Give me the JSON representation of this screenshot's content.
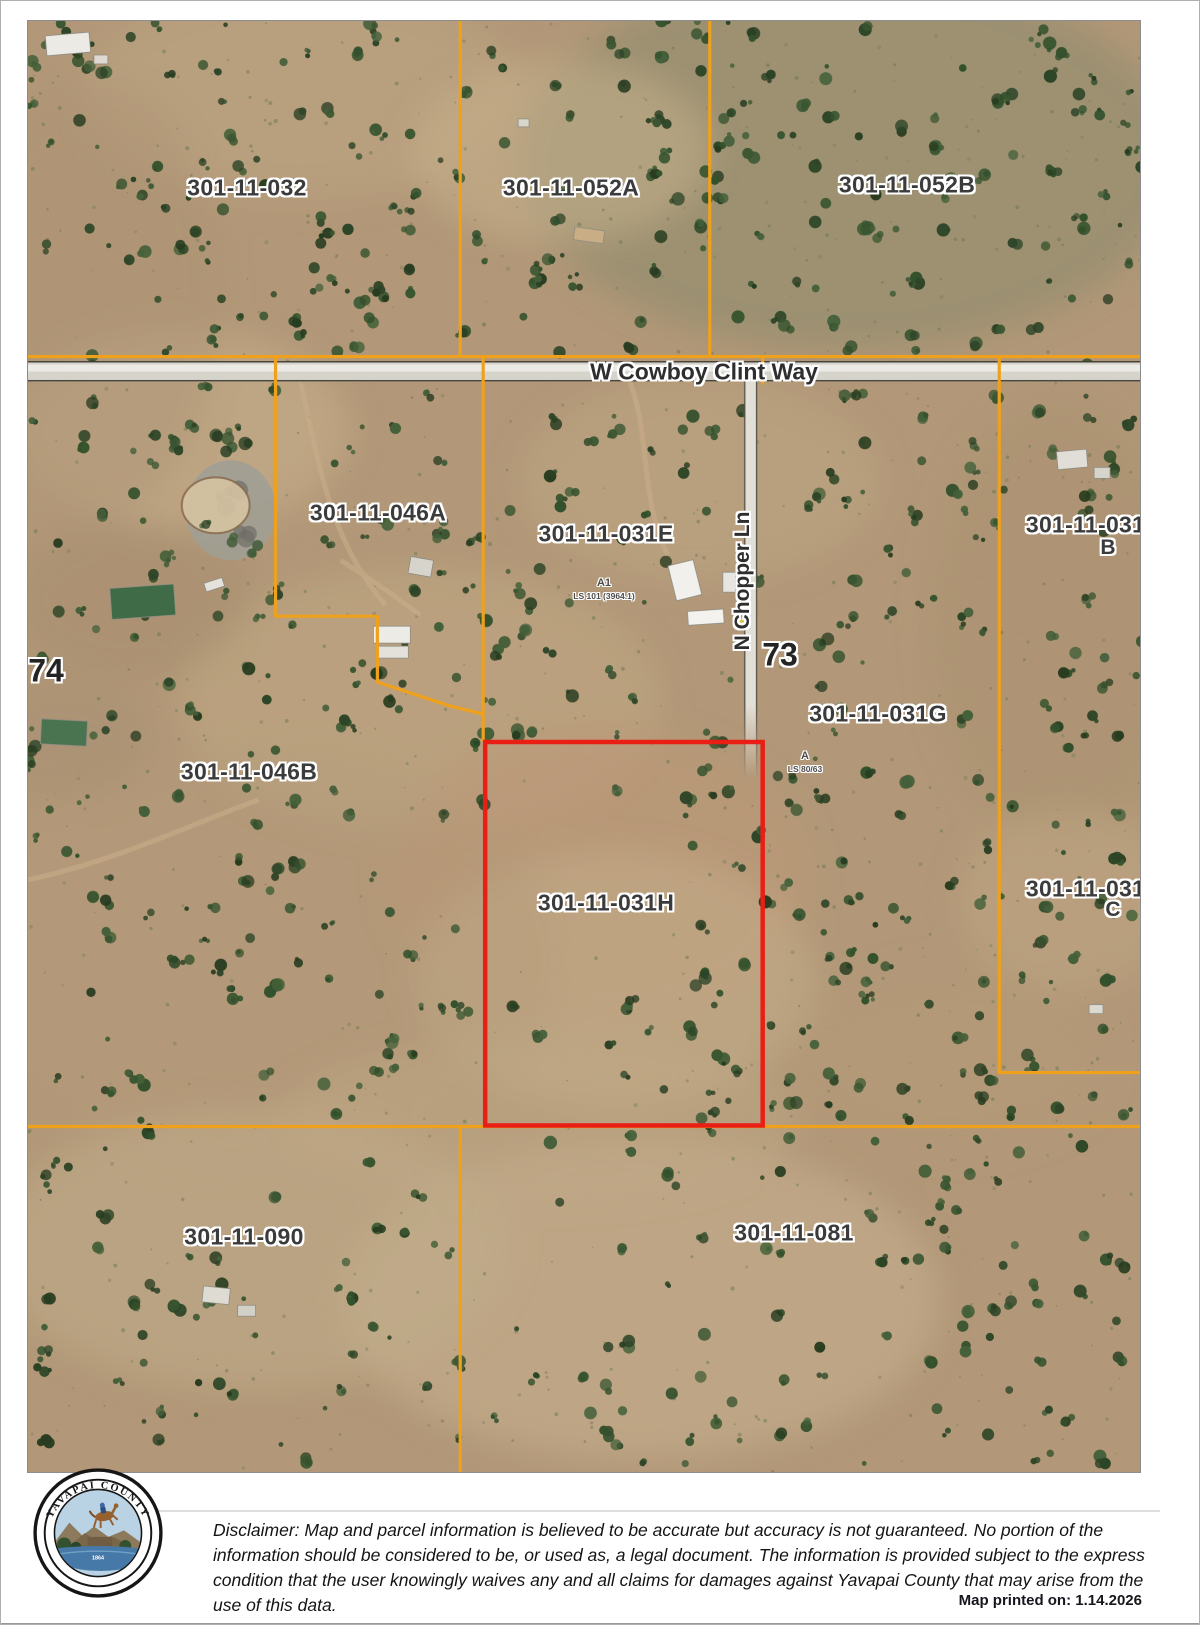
{
  "map": {
    "roads": {
      "horizontal_label": "W Cowboy Clint Way",
      "vertical_label": "N Chopper Ln"
    },
    "parcel_labels": [
      {
        "text": "301-11-032",
        "x": 246,
        "y": 187
      },
      {
        "text": "301-11-052A",
        "x": 570,
        "y": 187
      },
      {
        "text": "301-11-052B",
        "x": 906,
        "y": 184
      },
      {
        "text": "301-11-046A",
        "x": 377,
        "y": 512
      },
      {
        "text": "301-11-031E",
        "x": 605,
        "y": 533
      },
      {
        "text": "301-11-031C",
        "x": 1093,
        "y": 524
      },
      {
        "text": "301-11-031G",
        "x": 877,
        "y": 713
      },
      {
        "text": "301-11-046B",
        "x": 248,
        "y": 771
      },
      {
        "text": "301-11-031A",
        "x": 1093,
        "y": 888
      },
      {
        "text": "301-11-031H",
        "x": 605,
        "y": 902
      },
      {
        "text": "301-11-090",
        "x": 243,
        "y": 1236
      },
      {
        "text": "301-11-081",
        "x": 793,
        "y": 1232
      }
    ],
    "sub_parcel_letters": [
      {
        "text": "B",
        "x": 1107,
        "y": 547
      },
      {
        "text": "C",
        "x": 1112,
        "y": 909
      }
    ],
    "section_numbers": [
      {
        "text": "74",
        "x": 45,
        "y": 670
      },
      {
        "text": "73",
        "x": 779,
        "y": 654
      }
    ],
    "survey_annotations": [
      {
        "marker": "A1",
        "note": "LS 101 (3964.1)",
        "x": 603,
        "y": 588
      },
      {
        "marker": "A",
        "note": "LS 80/63",
        "x": 804,
        "y": 761
      }
    ],
    "highlighted_parcel": "301-11-031H",
    "colors": {
      "parcel_boundary": "#f0a11b",
      "highlight_boundary": "#e91e14",
      "road_fill": "#dcd9d1",
      "label_text": "#3b3b3b"
    }
  },
  "footer": {
    "seal": {
      "arc_top": "YAVAPAI COUNTY",
      "arc_bottom": "ARIZONA",
      "year": "1864"
    },
    "disclaimer_lines": [
      "Disclaimer: Map and parcel information is believed to be accurate but accuracy is not guaranteed. No portion of the",
      "information should be considered to be, or used as, a legal document.  The information is provided subject to the express",
      "condition that the user knowingly waives any and all claims for damages against Yavapai County that may arise from the",
      "use of this data."
    ],
    "printed_on": "Map printed on: 1.14.2026"
  }
}
